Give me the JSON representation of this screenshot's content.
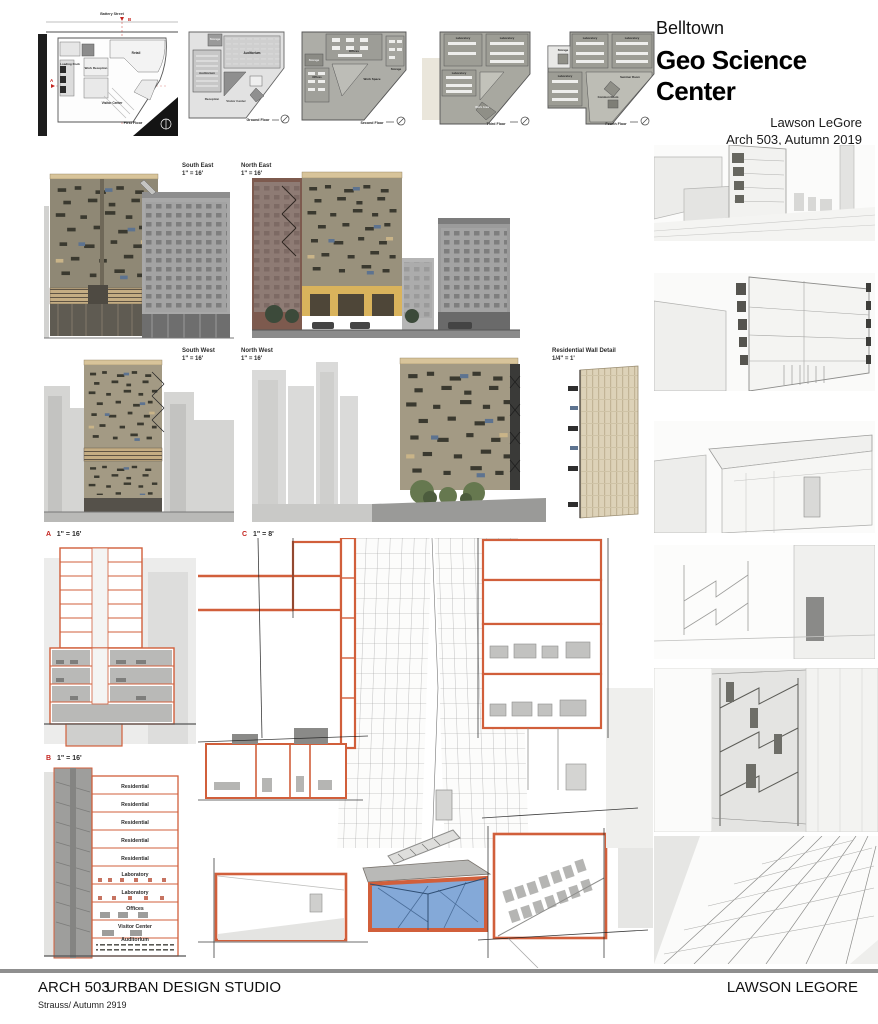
{
  "header": {
    "neighborhood": "Belltown",
    "title": "Geo Science Center",
    "author": "Lawson LeGore",
    "course": "Arch 503, Autumn 2019"
  },
  "footer": {
    "course": "ARCH 503",
    "studio": "URBAN DESIGN STUDIO",
    "credit": "Strauss/ Autumn 2919",
    "name": "LAWSON LEGORE"
  },
  "plans": [
    {
      "caption": "First Floor",
      "street": "Battery Street",
      "rooms": [
        "Retail",
        "Loading Dock",
        "Work Reception",
        "Visitor Center"
      ]
    },
    {
      "caption": "Ground Floor",
      "rooms": [
        "Storage",
        "Auditorium",
        "Auditorium",
        "Reception",
        "Visitor Center"
      ]
    },
    {
      "caption": "Second Floor",
      "rooms": [
        "Offices",
        "Storage",
        "Offices",
        "Work Space",
        "Storage"
      ]
    },
    {
      "caption": "Third Floor",
      "rooms": [
        "Laboratory",
        "Laboratory",
        "Laboratory",
        "Work Area"
      ]
    },
    {
      "caption": "Fourth Floor",
      "rooms": [
        "Laboratory",
        "Laboratory",
        "Storage",
        "Laboratory",
        "Seminar Room",
        "Common Room"
      ]
    }
  ],
  "elevations": [
    {
      "name": "South East",
      "scale": "1\" = 16'"
    },
    {
      "name": "North East",
      "scale": "1\" = 16'"
    },
    {
      "name": "South West",
      "scale": "1\" = 16'"
    },
    {
      "name": "North West",
      "scale": "1\" = 16'"
    },
    {
      "name": "Residential Wall Detail",
      "scale": "1/4\" = 1'"
    }
  ],
  "sections": [
    {
      "id": "A",
      "scale": "1\" = 16'"
    },
    {
      "id": "B",
      "scale": "1\" = 16'",
      "rooms": [
        "Residential",
        "Residential",
        "Residential",
        "Residential",
        "Residential",
        "Laboratory",
        "Laboratory",
        "Offices",
        "Visitor Center",
        "Auditorium"
      ]
    },
    {
      "id": "C",
      "scale": "1\" = 8'"
    }
  ],
  "colors": {
    "section_cut_orange": "#d15f3b",
    "facade_tan": "#a1987f",
    "pool_blue": "#84a9d8",
    "marker_red": "#c4241f"
  }
}
